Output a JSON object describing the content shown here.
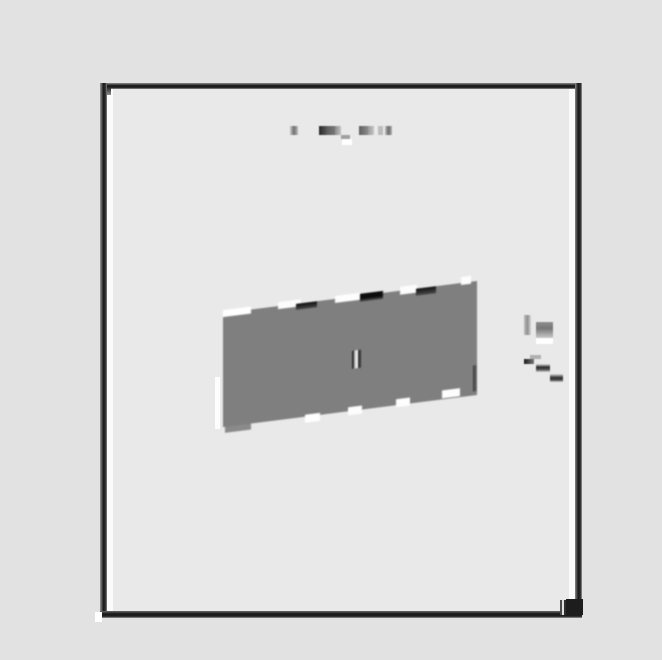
{
  "meta": {
    "description": "Low-resolution scanned document page: dark-framed page on gray canvas, blurred title line, tilted gray figure panel with edge chips, margin annotations, bottom-right corner marker",
    "canvas_width": 662,
    "canvas_height": 660
  },
  "palette": {
    "canvas_bg": "#e2e2e2",
    "page_fill": "#e9e9e9",
    "frame_dark": "#1c1c1c",
    "inner_margin_white": "#fbfbfb",
    "panel_gray": "#7f7f7f",
    "chip_white": "#ffffff",
    "chip_black": "#111111",
    "marker_dark": "#1d1d1d"
  },
  "page": {
    "x": 100,
    "y": 83,
    "width": 482,
    "height": 535,
    "border_thickness": 7,
    "fill": "#e9e9e9"
  },
  "frame": {
    "shapes": [
      {
        "name": "page-interior",
        "x": 100,
        "y": 83,
        "w": 482,
        "h": 535,
        "fill": "#e9e9e9",
        "z": 0
      },
      {
        "name": "frame-border-top",
        "x": 100,
        "y": 83,
        "w": 482,
        "h": 6,
        "fill": "linear-gradient(180deg,#8e8e8e,#151515 45%,#2a2a2a 80%,#9a9a9a)",
        "z": 2
      },
      {
        "name": "frame-border-left",
        "x": 100,
        "y": 83,
        "w": 7,
        "h": 535,
        "fill": "linear-gradient(90deg,#9a9a9a,#161616 50%,#333333 80%,#8a8a8a)",
        "z": 2
      },
      {
        "name": "frame-border-right",
        "x": 575,
        "y": 83,
        "w": 7,
        "h": 535,
        "fill": "linear-gradient(90deg,#8a8a8a,#1a1a1a 45%,#2e2e2e 80%,#9f9f9f)",
        "z": 2
      },
      {
        "name": "frame-border-bottom",
        "x": 100,
        "y": 611,
        "w": 482,
        "h": 7,
        "fill": "linear-gradient(180deg,#6a6a6a,#191919 40%,#202020 75%,#9a9a9a)",
        "z": 2
      },
      {
        "name": "inner-margin-left",
        "x": 107,
        "y": 89,
        "w": 6,
        "h": 522,
        "fill": "#fbfbfb",
        "z": 1
      },
      {
        "name": "inner-margin-right",
        "x": 569,
        "y": 89,
        "w": 6,
        "h": 522,
        "fill": "#fbfbfb",
        "z": 1
      }
    ]
  },
  "title_blocks": {
    "shapes": [
      {
        "name": "title-glyph",
        "x": 290,
        "y": 126,
        "w": 8,
        "h": 9,
        "fill": "linear-gradient(90deg,#c9c9c9,#6f6f6f 50%,#bdbdbd)"
      },
      {
        "name": "title-glyph",
        "x": 319,
        "y": 126,
        "w": 8,
        "h": 9,
        "fill": "linear-gradient(90deg,#2a2a2a,#5a5a5a)"
      },
      {
        "name": "title-glyph",
        "x": 327,
        "y": 126,
        "w": 8,
        "h": 9,
        "fill": "linear-gradient(90deg,#606060,#767676)"
      },
      {
        "name": "title-glyph",
        "x": 335,
        "y": 126,
        "w": 6,
        "h": 9,
        "fill": "linear-gradient(90deg,#8b8b8b,#c2c2c2)"
      },
      {
        "name": "title-underscore",
        "x": 341,
        "y": 135,
        "w": 9,
        "h": 4,
        "fill": "#a0a0a0"
      },
      {
        "name": "title-underscore-highlight",
        "x": 342,
        "y": 139,
        "w": 10,
        "h": 6,
        "fill": "#ffffff"
      },
      {
        "name": "title-glyph",
        "x": 359,
        "y": 126,
        "w": 9,
        "h": 9,
        "fill": "linear-gradient(90deg,#5f5f5f,#8a8a8a)"
      },
      {
        "name": "title-glyph",
        "x": 368,
        "y": 126,
        "w": 6,
        "h": 9,
        "fill": "linear-gradient(90deg,#9a9a9a,#c5c5c5)"
      },
      {
        "name": "title-glyph",
        "x": 378,
        "y": 126,
        "w": 5,
        "h": 9,
        "fill": "#bdbdbd"
      },
      {
        "name": "title-glyph",
        "x": 385,
        "y": 126,
        "w": 7,
        "h": 9,
        "fill": "linear-gradient(90deg,#c0c0c0,#6a6a6a 50%,#b0b0b0)"
      }
    ]
  },
  "panel": {
    "x": 223,
    "y": 281,
    "width": 254,
    "height": 114,
    "skew_deg": -7.2,
    "fill": "#7f7f7f",
    "top_edge_chips": [
      {
        "name": "top-edge-chip-white",
        "x": 0,
        "y": -3,
        "w": 28,
        "h": 7,
        "fill": "#ffffff"
      },
      {
        "name": "top-edge-chip-white",
        "x": 55,
        "y": -4,
        "w": 23,
        "h": 7,
        "fill": "#fcfcfc"
      },
      {
        "name": "top-edge-chip-dark",
        "x": 73,
        "y": 0,
        "w": 21,
        "h": 6,
        "fill": "linear-gradient(180deg,#0d0d0d,#474747)"
      },
      {
        "name": "top-edge-chip-white",
        "x": 112,
        "y": -3,
        "w": 25,
        "h": 7,
        "fill": "#fdfdfd"
      },
      {
        "name": "top-edge-chip-dark",
        "x": 137,
        "y": -2,
        "w": 23,
        "h": 8,
        "fill": "linear-gradient(180deg,#0c0c0c 60%,#555555)"
      },
      {
        "name": "top-edge-chip-white",
        "x": 177,
        "y": -4,
        "w": 17,
        "h": 8,
        "fill": "#fcfcfc"
      },
      {
        "name": "top-edge-chip-dark",
        "x": 193,
        "y": 0,
        "w": 20,
        "h": 7,
        "fill": "linear-gradient(180deg,#101010,#4a4a4a)"
      },
      {
        "name": "top-edge-chip-white",
        "x": 238,
        "y": -6,
        "w": 10,
        "h": 8,
        "fill": "#fdfdfd"
      }
    ],
    "bottom_edge_notches": [
      {
        "name": "bottom-edge-notch",
        "x": 82,
        "y": 112,
        "w": 15,
        "h": 8,
        "fill": "#ffffff"
      },
      {
        "name": "bottom-edge-notch",
        "x": 125,
        "y": 110,
        "w": 14,
        "h": 8,
        "fill": "#fdfdfd"
      },
      {
        "name": "bottom-edge-notch",
        "x": 173,
        "y": 108,
        "w": 14,
        "h": 8,
        "fill": "#fdfdfd"
      },
      {
        "name": "bottom-edge-notch",
        "x": 219,
        "y": 105,
        "w": 18,
        "h": 8,
        "fill": "#fdfdfd"
      }
    ],
    "extras": [
      {
        "name": "panel-bottom-step",
        "x": 2,
        "y": 114,
        "w": 26,
        "h": 6,
        "fill": "#8a8a8a"
      },
      {
        "name": "panel-right-edge-shade",
        "x": 250,
        "y": 84,
        "w": 4,
        "h": 26,
        "fill": "linear-gradient(90deg,#3a3a3a,#6f6f6f)"
      }
    ],
    "center_slot": {
      "name": "panel-center-slot",
      "x": 129,
      "y": 54,
      "w": 9,
      "h": 18,
      "fill": "linear-gradient(90deg,#2b2b2b 0px,#2b2b2b 2px,#bdbdbd 2px,#bdbdbd 4px,#f5f5f5 4px,#f5f5f5 6px,#383838 6px,#383838 9px)"
    }
  },
  "annotations": {
    "shapes": [
      {
        "name": "margin-annotation-bar",
        "x": 524,
        "y": 315,
        "w": 7,
        "h": 20,
        "fill": "linear-gradient(90deg,#bdbdbd,#8f8f8f 50%,#d8d8d8)"
      },
      {
        "name": "margin-annotation-block",
        "x": 536,
        "y": 322,
        "w": 17,
        "h": 16,
        "fill": "linear-gradient(180deg,#8f8f8f,#777777 40%,#c9c9c9)"
      },
      {
        "name": "margin-annotation-underline",
        "x": 536,
        "y": 338,
        "w": 17,
        "h": 6,
        "fill": "#ffffff"
      },
      {
        "name": "leader-dash",
        "x": 530,
        "y": 355,
        "w": 11,
        "h": 4,
        "fill": "#b0b0b0"
      },
      {
        "name": "leader-dash",
        "x": 524,
        "y": 359,
        "w": 10,
        "h": 5,
        "fill": "linear-gradient(90deg,#1c1c1c,#777777)"
      },
      {
        "name": "leader-dash",
        "x": 536,
        "y": 364,
        "w": 14,
        "h": 8,
        "fill": "linear-gradient(180deg,#e0e0e0,#2a2a2a 40%,#555555 70%,#cfcfcf)"
      },
      {
        "name": "leader-dash",
        "x": 550,
        "y": 374,
        "w": 13,
        "h": 8,
        "fill": "linear-gradient(180deg,#dcdcdc,#303030 45%,#4a4a4a 75%,#d0d0d0)"
      }
    ]
  },
  "marks": {
    "shapes": [
      {
        "name": "top-left-inner-tick",
        "x": 107,
        "y": 88,
        "w": 4,
        "h": 7,
        "fill": "linear-gradient(180deg,#2e2e2e,#8e8e8e)",
        "z": 4
      },
      {
        "name": "bottom-left-notch",
        "x": 95,
        "y": 612,
        "w": 7,
        "h": 10,
        "fill": "#ffffff",
        "z": 5
      },
      {
        "name": "panel-left-white-strip",
        "x": 215,
        "y": 377,
        "w": 5,
        "h": 52,
        "fill": "#fdfdfd",
        "z": 3
      },
      {
        "name": "corner-marker-stripes",
        "x": 560,
        "y": 600,
        "w": 7,
        "h": 15,
        "fill": "linear-gradient(90deg,#4a4a4a 0px,#4a4a4a 2px,#e0e0e0 2px,#e0e0e0 4px,#2e2e2e 4px,#2e2e2e 7px)",
        "z": 5
      },
      {
        "name": "corner-marker-square",
        "x": 566,
        "y": 599,
        "w": 17,
        "h": 16,
        "fill": "#1d1d1d",
        "z": 6
      }
    ]
  }
}
